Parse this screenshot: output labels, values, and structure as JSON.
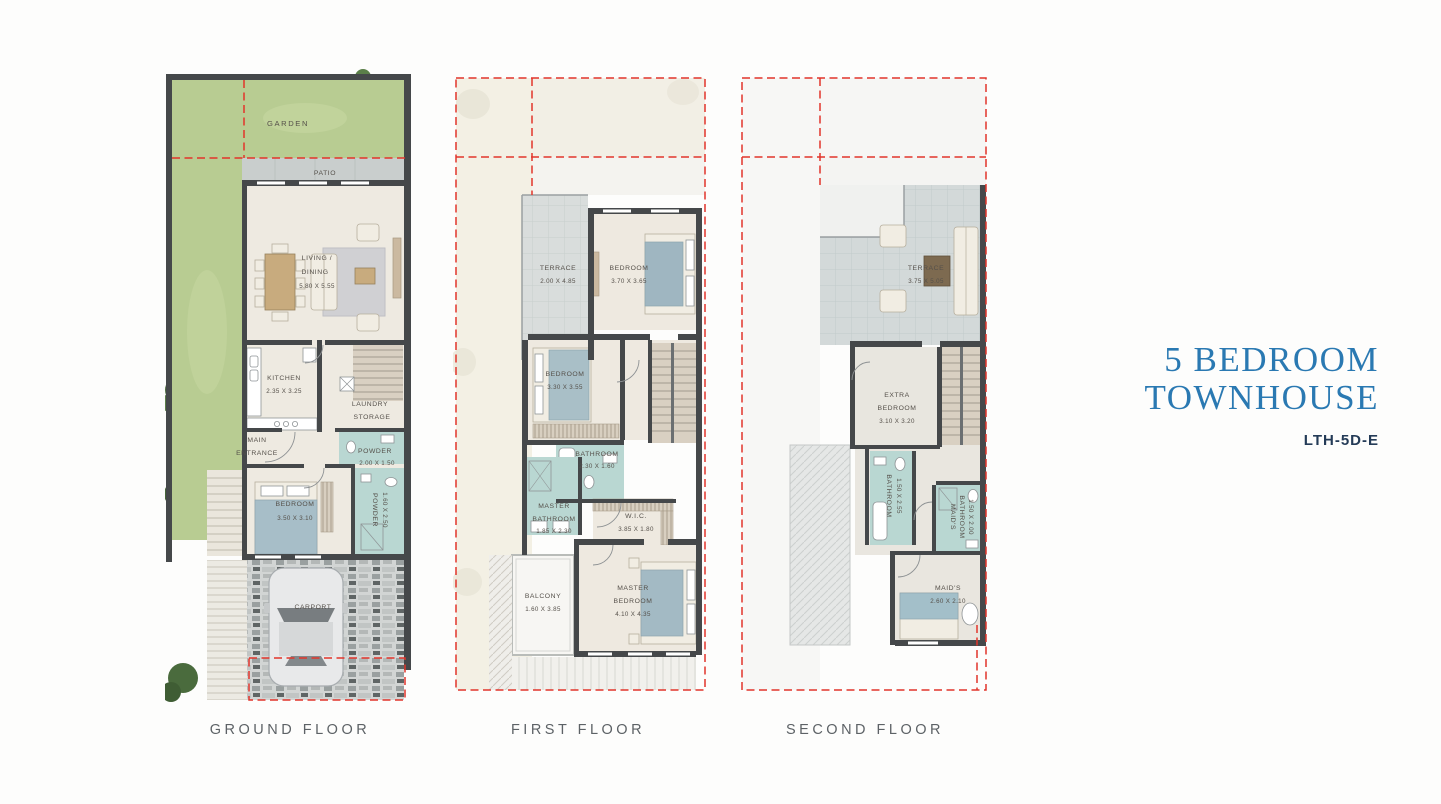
{
  "title": {
    "line1": "5 BEDROOM",
    "line2": "TOWNHOUSE",
    "code": "LTH-5D-E"
  },
  "colors": {
    "title_blue": "#2a79b2",
    "code_navy": "#243b57",
    "caption_gray": "#5d6266",
    "boundary_red": "#e2352b",
    "wall_dark": "#45484a",
    "garden_green": "#b8cc92",
    "bathroom_teal": "#b9d7d2",
    "floor_beige": "#eeeae1",
    "label_gray": "#55504a"
  },
  "floors": {
    "ground": {
      "label": "GROUND FLOOR",
      "rooms": {
        "garden": {
          "name": "GARDEN"
        },
        "patio": {
          "name": "PATIO"
        },
        "living_dining": {
          "lines": [
            "LIVING /",
            "DINING"
          ],
          "dims": "5.80 X 5.55"
        },
        "kitchen": {
          "name": "KITCHEN",
          "dims": "2.35 X 3.25"
        },
        "laundry_storage": {
          "lines": [
            "LAUNDRY",
            "STORAGE"
          ]
        },
        "main_entrance": {
          "lines": [
            "MAIN",
            "ENTRANCE"
          ]
        },
        "powder": {
          "name": "POWDER",
          "dims": "2.00 X 1.50"
        },
        "powder_2": {
          "name": "POWDER",
          "dims": "1.60 X 2.50"
        },
        "bedroom": {
          "name": "BEDROOM",
          "dims": "3.50 X 3.10"
        },
        "carport": {
          "name": "CARPORT"
        }
      }
    },
    "first": {
      "label": "FIRST FLOOR",
      "rooms": {
        "terrace": {
          "name": "TERRACE",
          "dims": "2.00 X 4.85"
        },
        "bedroom_1": {
          "name": "BEDROOM",
          "dims": "3.70 X 3.65"
        },
        "bedroom_2": {
          "name": "BEDROOM",
          "dims": "3.30 X 3.55"
        },
        "bathroom": {
          "name": "BATHROOM",
          "dims": "2.30 X 1.60"
        },
        "master_bathroom": {
          "lines": [
            "MASTER",
            "BATHROOM"
          ],
          "dims": "1.85 X 2.30"
        },
        "wic": {
          "name": "W.I.C.",
          "dims": "3.85 X 1.80"
        },
        "balcony": {
          "name": "BALCONY",
          "dims": "1.60 X 3.85"
        },
        "master_bedroom": {
          "lines": [
            "MASTER",
            "BEDROOM"
          ],
          "dims": "4.10 X 4.35"
        }
      }
    },
    "second": {
      "label": "SECOND FLOOR",
      "rooms": {
        "terrace": {
          "name": "TERRACE",
          "dims": "3.75 X 5.05"
        },
        "extra_bedroom": {
          "lines": [
            "EXTRA",
            "BEDROOM"
          ],
          "dims": "3.10 X 3.20"
        },
        "bathroom": {
          "name": "BATHROOM",
          "dims": "1.50 X 2.55"
        },
        "maids_bathroom": {
          "lines": [
            "MAID'S",
            "BATHROOM"
          ],
          "dims": "1.50 X 2.00"
        },
        "maids": {
          "name": "MAID'S",
          "dims": "2.60 X 2.10"
        }
      }
    }
  }
}
